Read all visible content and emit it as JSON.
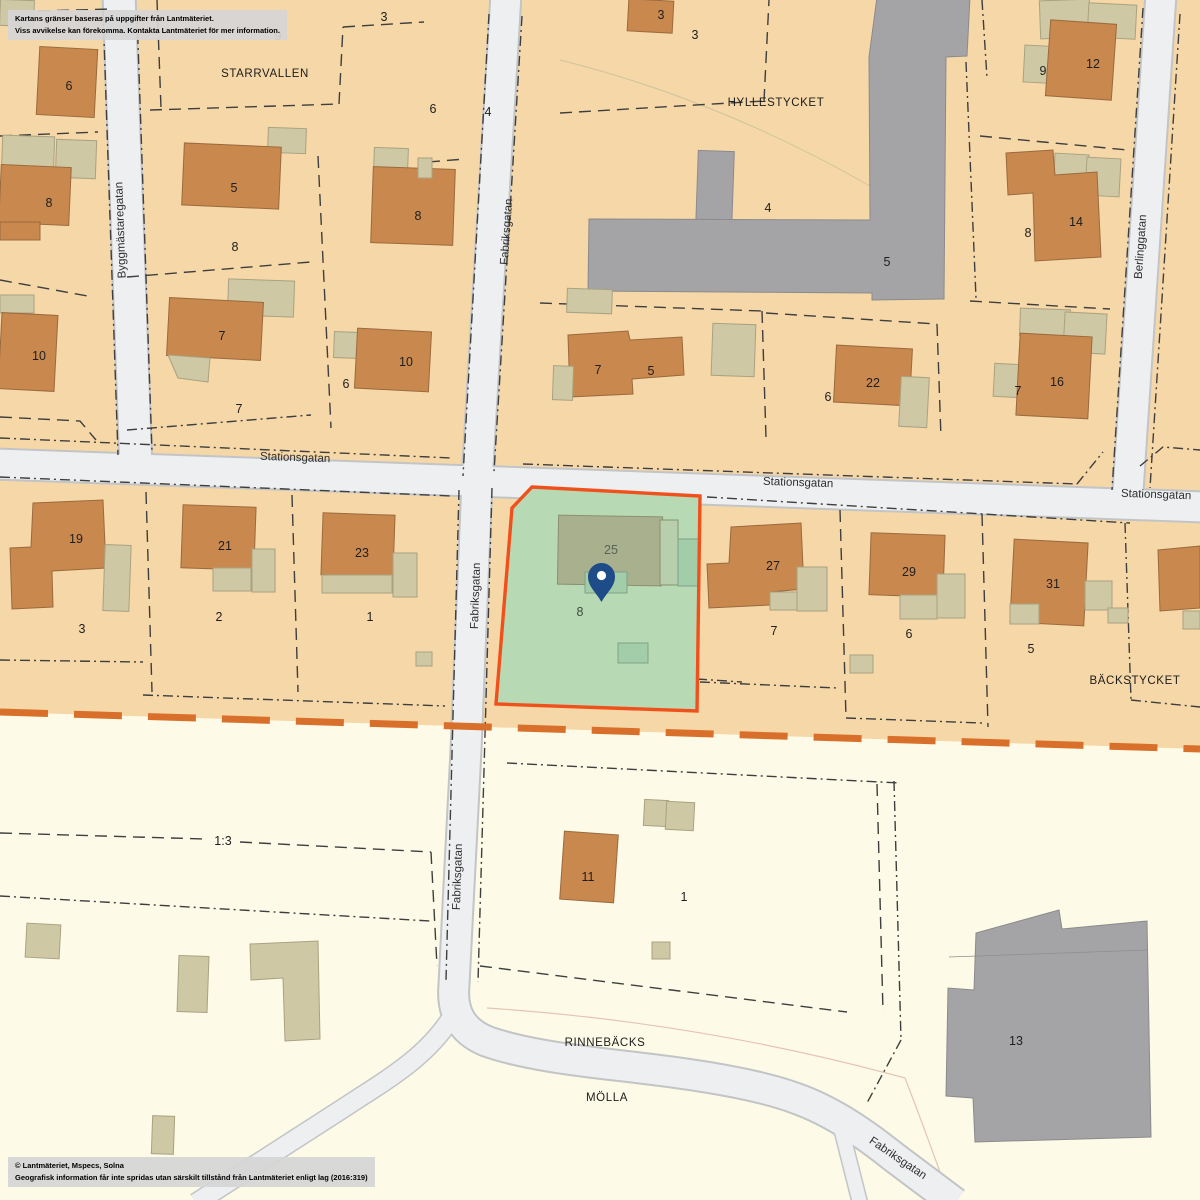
{
  "notice": {
    "line1": "Kartans gränser baseras på uppgifter från Lantmäteriet.",
    "line2": "Viss avvikelse kan förekomma. Kontakta Lantmäteriet för mer information."
  },
  "attribution": {
    "line1": "© Lantmäteriet, Mspecs, Solna",
    "line2": "Geografisk information får inte spridas utan särskilt tillstånd från Lantmäteriet enligt lag (2016:319)"
  },
  "street_names": {
    "byggmastaregatan": "Byggmästaregatan",
    "fabriksgatan": "Fabriksgatan",
    "stationsgatan": "Stationsgatan",
    "berlinggatan": "Berlinggatan"
  },
  "street_labels": [
    "Byggmästaregatan",
    "Fabriksgatan",
    "Stationsgatan",
    "Stationsgatan",
    "Stationsgatan",
    "Fabriksgatan",
    "Fabriksgatan",
    "Berlinggatan",
    "Fabriksgatan"
  ],
  "area_labels": [
    "STARRVALLEN",
    "HYLLESTYCKET",
    "BÄCKSTYCKET",
    "RINNEBÄCKS",
    "MÖLLA"
  ],
  "parcel_label": "1:3",
  "selected_property": {
    "building_label": "25",
    "address_label": "8",
    "marker": "map-pin"
  },
  "numbers": [
    "9",
    "3",
    "6",
    "8",
    "10",
    "5",
    "8",
    "7",
    "7",
    "6",
    "10",
    "6",
    "4",
    "8",
    "3",
    "3",
    "4",
    "5",
    "9",
    "12",
    "14",
    "8",
    "7",
    "5",
    "6",
    "22",
    "16",
    "7",
    "19",
    "3",
    "21",
    "2",
    "23",
    "1",
    "27",
    "7",
    "29",
    "6",
    "31",
    "5",
    "11",
    "1",
    "13"
  ],
  "colors": {
    "urban_bg": "#F6D7A7",
    "rural_bg": "#FDFBE7",
    "road_fill": "#EDEFF1",
    "road_edge": "#C2C4C6",
    "building": "#C9884E",
    "outbuilding": "#CFC8A5",
    "public_building": "#A4A4A6",
    "boundary_line": "#3E3E3E",
    "area_boundary": "#D8702C",
    "selection_fill": "#B7DAB4",
    "selection_outline": "#F0511C",
    "selection_building": "#A9B08E",
    "selection_outbuilding": "#A2CDA8",
    "pin": "#1D4C88"
  }
}
